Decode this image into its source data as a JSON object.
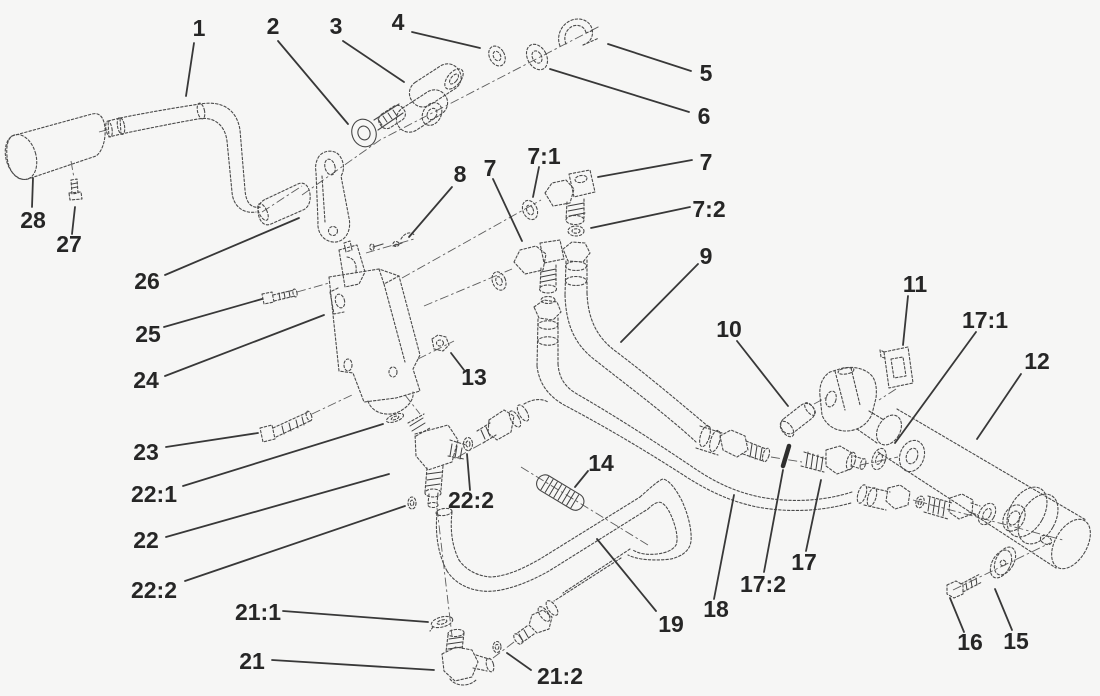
{
  "figure": {
    "type": "exploded-parts-diagram",
    "background": "#f6f6f5",
    "line_color": "#4a4a4a",
    "label_color": "#262626",
    "leader_color": "#383838",
    "label_font_size": 23
  },
  "callouts": [
    {
      "label": "1",
      "x": 199,
      "y": 28,
      "leader": [
        194,
        43,
        186,
        96
      ]
    },
    {
      "label": "2",
      "x": 273,
      "y": 26,
      "leader": [
        278,
        41,
        348,
        124
      ]
    },
    {
      "label": "3",
      "x": 336,
      "y": 26,
      "leader": [
        343,
        41,
        404,
        82
      ]
    },
    {
      "label": "4",
      "x": 398,
      "y": 22,
      "leader": [
        412,
        32,
        480,
        48
      ]
    },
    {
      "label": "5",
      "x": 706,
      "y": 73,
      "leader": [
        691,
        71,
        608,
        44
      ]
    },
    {
      "label": "6",
      "x": 704,
      "y": 116,
      "leader": [
        689,
        112,
        550,
        69
      ]
    },
    {
      "label": "7",
      "x": 706,
      "y": 162,
      "leader": [
        692,
        160,
        598,
        177
      ]
    },
    {
      "label": "7:1",
      "x": 544,
      "y": 156,
      "leader": [
        539,
        167,
        533,
        197
      ]
    },
    {
      "label": "7:2",
      "x": 709,
      "y": 209,
      "leader": [
        690,
        207,
        591,
        228
      ]
    },
    {
      "label": "7",
      "x": 490,
      "y": 168,
      "leader": [
        493,
        179,
        522,
        241
      ]
    },
    {
      "label": "8",
      "x": 460,
      "y": 174,
      "leader": [
        452,
        187,
        409,
        237
      ]
    },
    {
      "label": "9",
      "x": 706,
      "y": 256,
      "leader": [
        698,
        264,
        621,
        342
      ]
    },
    {
      "label": "10",
      "x": 729,
      "y": 329,
      "leader": [
        737,
        341,
        788,
        406
      ]
    },
    {
      "label": "11",
      "x": 915,
      "y": 284,
      "leader": [
        908,
        296,
        903,
        345
      ]
    },
    {
      "label": "12",
      "x": 1037,
      "y": 361,
      "leader": [
        1021,
        374,
        977,
        439
      ]
    },
    {
      "label": "13",
      "x": 474,
      "y": 377,
      "leader": [
        464,
        370,
        451,
        353
      ]
    },
    {
      "label": "14",
      "x": 601,
      "y": 463,
      "leader": [
        588,
        471,
        575,
        487
      ]
    },
    {
      "label": "15",
      "x": 1016,
      "y": 641,
      "leader": [
        1012,
        630,
        995,
        589
      ]
    },
    {
      "label": "16",
      "x": 970,
      "y": 642,
      "leader": [
        964,
        632,
        950,
        598
      ]
    },
    {
      "label": "17",
      "x": 804,
      "y": 562,
      "leader": [
        806,
        551,
        821,
        480
      ]
    },
    {
      "label": "17:1",
      "x": 985,
      "y": 320,
      "leader": [
        976,
        332,
        895,
        443
      ]
    },
    {
      "label": "17:2",
      "x": 763,
      "y": 584,
      "leader": [
        764,
        572,
        783,
        470
      ]
    },
    {
      "label": "18",
      "x": 716,
      "y": 609,
      "leader": [
        714,
        599,
        734,
        495
      ]
    },
    {
      "label": "19",
      "x": 671,
      "y": 624,
      "leader": [
        656,
        611,
        597,
        539
      ]
    },
    {
      "label": "21",
      "x": 252,
      "y": 661,
      "leader": [
        272,
        660,
        434,
        670
      ]
    },
    {
      "label": "21:1",
      "x": 258,
      "y": 612,
      "leader": [
        283,
        611,
        428,
        622
      ]
    },
    {
      "label": "21:2",
      "x": 560,
      "y": 676,
      "leader": [
        531,
        670,
        507,
        653
      ]
    },
    {
      "label": "22",
      "x": 146,
      "y": 540,
      "leader": [
        166,
        537,
        389,
        474
      ]
    },
    {
      "label": "22:1",
      "x": 154,
      "y": 494,
      "leader": [
        183,
        486,
        383,
        424
      ]
    },
    {
      "label": "22:2",
      "x": 154,
      "y": 590,
      "leader": [
        185,
        581,
        405,
        506
      ]
    },
    {
      "label": "22:2",
      "x": 471,
      "y": 500,
      "leader": [
        470,
        490,
        467,
        454
      ]
    },
    {
      "label": "23",
      "x": 146,
      "y": 452,
      "leader": [
        166,
        447,
        258,
        433
      ]
    },
    {
      "label": "24",
      "x": 146,
      "y": 380,
      "leader": [
        165,
        376,
        324,
        315
      ]
    },
    {
      "label": "25",
      "x": 148,
      "y": 334,
      "leader": [
        164,
        327,
        262,
        299
      ]
    },
    {
      "label": "26",
      "x": 147,
      "y": 281,
      "leader": [
        165,
        275,
        299,
        218
      ]
    },
    {
      "label": "27",
      "x": 69,
      "y": 244,
      "leader": [
        72,
        234,
        75,
        207
      ]
    },
    {
      "label": "28",
      "x": 33,
      "y": 220,
      "leader": [
        32,
        207,
        33,
        178
      ]
    }
  ]
}
